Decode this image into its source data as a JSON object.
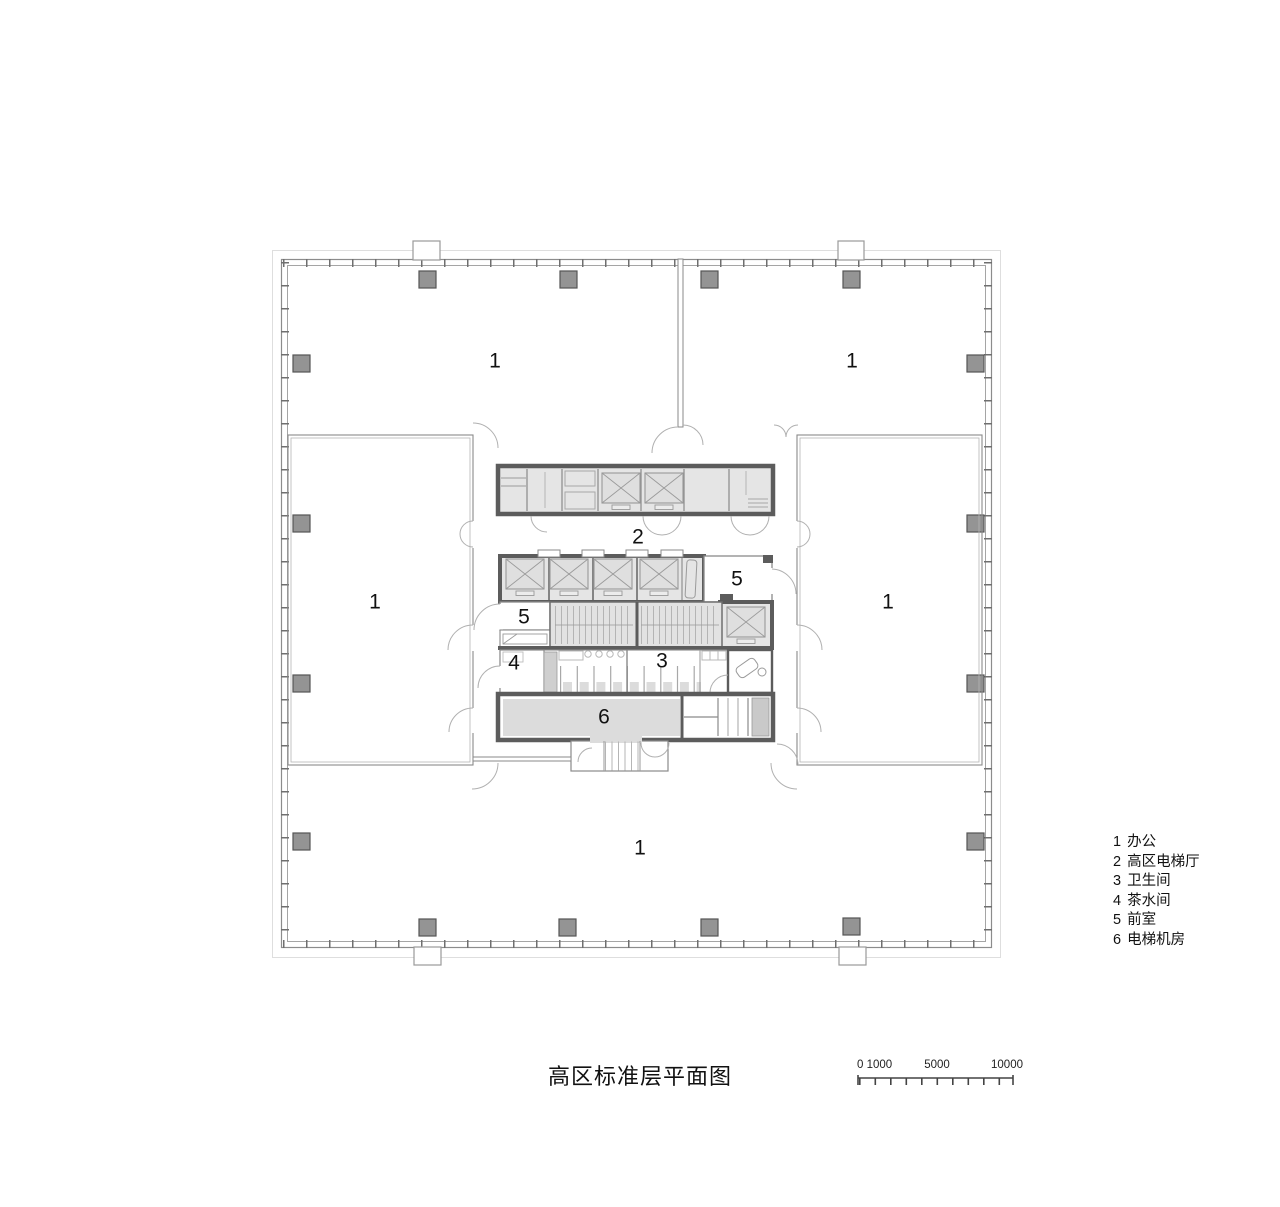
{
  "title": "高区标准层平面图",
  "legend": {
    "items": [
      {
        "num": "1",
        "label": "办公"
      },
      {
        "num": "2",
        "label": "高区电梯厅"
      },
      {
        "num": "3",
        "label": "卫生间"
      },
      {
        "num": "4",
        "label": "茶水间"
      },
      {
        "num": "5",
        "label": "前室"
      },
      {
        "num": "6",
        "label": "电梯机房"
      }
    ]
  },
  "plan": {
    "room_labels": [
      {
        "room": "office-top-left",
        "text": "1"
      },
      {
        "room": "office-top-right",
        "text": "1"
      },
      {
        "room": "office-mid-left",
        "text": "1"
      },
      {
        "room": "office-mid-right",
        "text": "1"
      },
      {
        "room": "office-bottom",
        "text": "1"
      },
      {
        "room": "elevator-hall",
        "text": "2"
      },
      {
        "room": "front-room-right",
        "text": "5"
      },
      {
        "room": "front-room-left",
        "text": "5"
      },
      {
        "room": "tea-room",
        "text": "4"
      },
      {
        "room": "washroom",
        "text": "3"
      },
      {
        "room": "elevator-machine-room",
        "text": "6"
      }
    ]
  },
  "scale_bar": {
    "labels": [
      "0 1000",
      "5000",
      "10000"
    ]
  },
  "colors": {
    "core_wall": "#5c5c5c",
    "partition_line": "#8a8a8a",
    "room_fill": "#e4e4e4",
    "column_fill": "#949494",
    "text": "#111111"
  }
}
